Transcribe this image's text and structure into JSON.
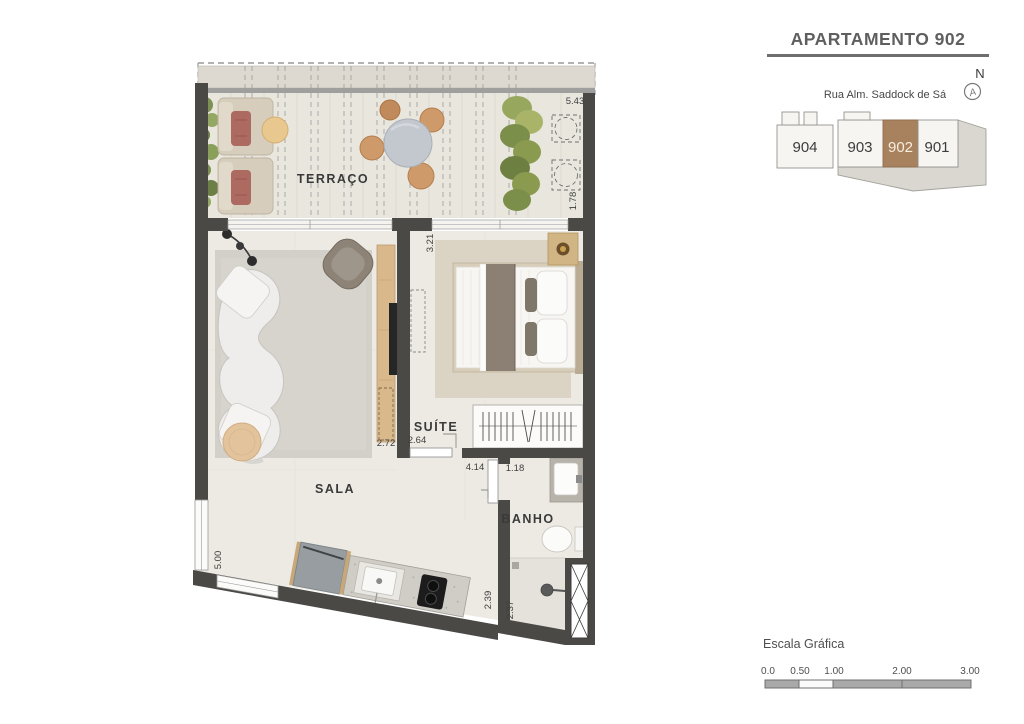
{
  "header": {
    "title": "APARTAMENTO 902"
  },
  "keyplan": {
    "street_label": "Rua Alm. Saddock de Sá",
    "compass_letter": "N",
    "compass_glyph": "A",
    "units": [
      "904",
      "903",
      "902",
      "901"
    ],
    "highlighted_unit": "902",
    "highlight_color": "#a8815f"
  },
  "plan": {
    "room_labels": {
      "terraco": "TERRAÇO",
      "sala": "SALA",
      "suite": "SUÍTE",
      "banho": "BANHO"
    },
    "dimensions": {
      "terraco_width": "5.43",
      "terraco_depth": "1.78",
      "suite_depth": "3.21",
      "suite_width": "2.64",
      "tv_wall": "2.72",
      "hall_width": "4.14",
      "banho_width": "1.18",
      "sala_depth": "5.00",
      "cozinha_depth": "2.39",
      "box_depth": "2.37"
    }
  },
  "scalebar": {
    "label": "Escala Gráfica",
    "ticks": [
      "0.0",
      "0.50",
      "1.00",
      "2.00",
      "3.00"
    ]
  }
}
